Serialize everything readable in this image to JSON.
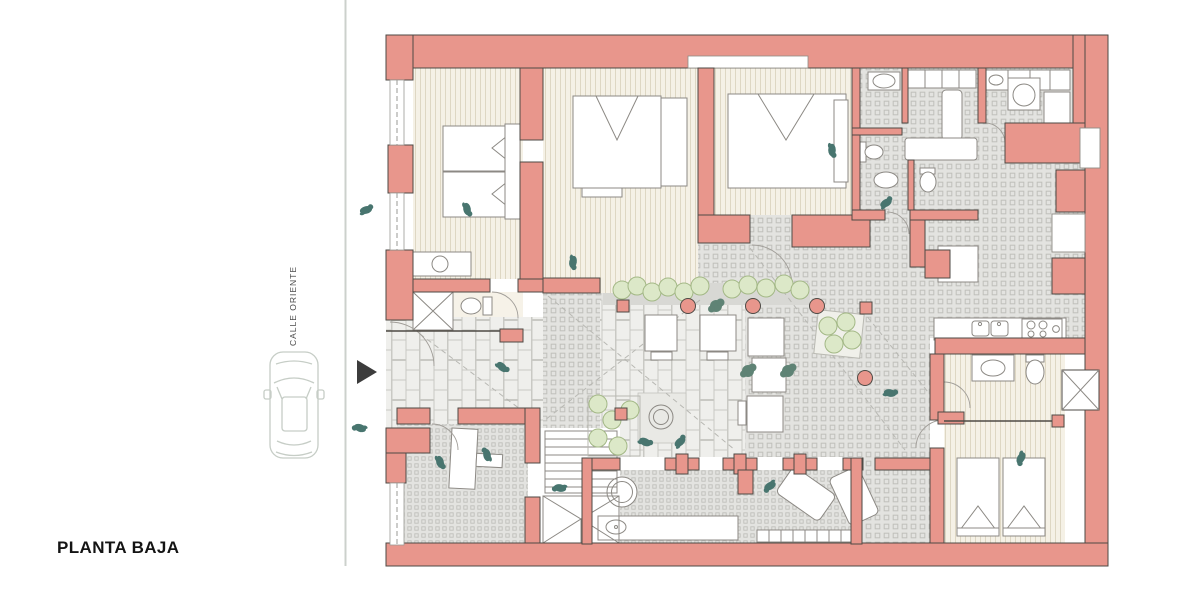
{
  "labels": {
    "title": "PLANTA BAJA",
    "street": "CALLE ORIENTE"
  },
  "palette": {
    "wall": "#e8968c",
    "wall_outline": "#4e4a45",
    "wood_floor": "#f5f1e6",
    "wood_stripe": "#ded7c3",
    "bath_floor": "#f6f2e8",
    "tile_floor": "#e3e3e0",
    "tile_motif": "#c0c0bb",
    "paver_floor": "#efefec",
    "paver_line": "#c9c9c4",
    "walk_strip": "#d8d8d4",
    "furniture_line": "#8c8984",
    "furniture_fill": "#ffffff",
    "plant_fill": "#dce8c8",
    "plant_line": "#a3b886",
    "plant_dark": "#5f8375",
    "person": "#48756f",
    "street_line": "#ccd1cc",
    "car_line": "#c6cdc6",
    "arrow": "#3c3c3c",
    "ink": "#141414"
  }
}
